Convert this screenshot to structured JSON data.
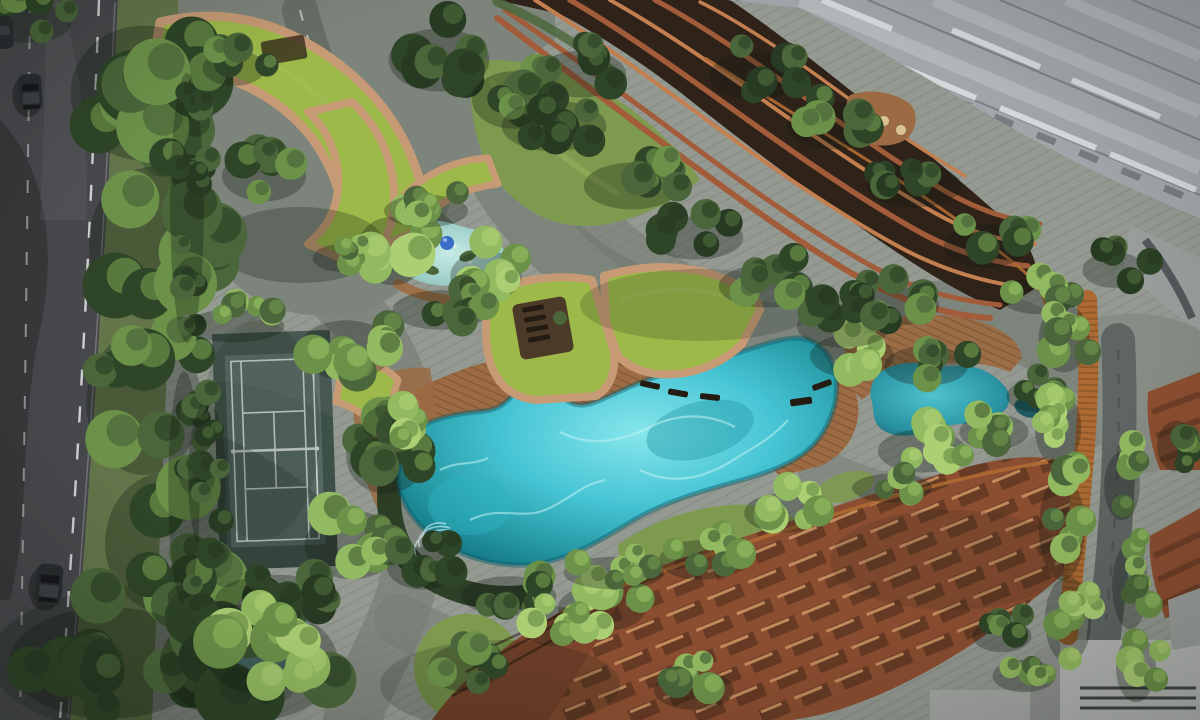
{
  "scene": {
    "type": "architectural-aerial-rendering",
    "description": "Top-down day rendering of a condominium landscape deck: free-form lagoon pool, tennis court, curved green-roof canopies, terracotta balcony towers, timber decks, corten boardwalk and dense tropical planting beside a tree-lined avenue",
    "text_visible": false
  },
  "features": [
    "two-lane-avenue-with-street-trees",
    "parked-cars",
    "arrival-court-with-curved-green-roof-canopies",
    "tennis-court",
    "kids-water-play-pool-with-blue-ball",
    "fan-shaped-green-roof-pool-pavilion",
    "free-form-lagoon-pool",
    "timber-sun-decks",
    "leisure-pond",
    "paver-promenade",
    "corten-steel-boardwalk",
    "terracotta-balcony-tower",
    "high-rise-tower-diagonal-facade",
    "rooftop-terrace-with-daybeds",
    "terraced-terracotta-roofscape",
    "grey-podium-roofs",
    "lawn-mounds-and-hedges"
  ],
  "vehicles": {
    "count": 3,
    "body_color": "#2a2d2f"
  },
  "colors": {
    "asphalt": "#46484b",
    "roadMark": "#e6e8e7",
    "verge": "#64754a",
    "lawn": "#7e9a4f",
    "lawnLight": "#a8c166",
    "canopyGreen": "#9cb94a",
    "canopyRim": "#c69a74",
    "canopyRimDark": "#9b6946",
    "treeDark": "#2e4527",
    "treeMid": "#4a663a",
    "treeLight": "#6c9249",
    "treePale": "#92ba60",
    "palm": "#adcf74",
    "hedge": "#273a22",
    "paving": "#949a92",
    "pavingDark": "#767d74",
    "pavingDeep": "#5e655e",
    "deck": "#9c6b43",
    "deckLight": "#bb8b59",
    "poolDeep": "#0f6f7e",
    "poolMid": "#2aa2b4",
    "poolBright": "#57d0de",
    "poolPale": "#aef0f2",
    "kidsPool": "#9cd2cc",
    "pondTeal": "#2f9fae",
    "pondDark": "#1e5a63",
    "courtBase": "#3d5048",
    "courtInner": "#5e706c",
    "courtLine": "#ccd5d1",
    "terracotta": "#a25c3a",
    "terracottaLight": "#c47f51",
    "terracottaDark": "#2f2219",
    "roofBase": "#8c4e31",
    "roofLight": "#c68e60",
    "roofShadow": "#432818",
    "towerGrey": "#a2a6aa",
    "towerLight": "#c6c9cc",
    "towerDark": "#55595d",
    "towerWhite": "#dcdee0",
    "corten": "#ad6a33",
    "cortenDark": "#7c4a22",
    "carBody": "#2a2d2f",
    "ball": "#3a6cc8"
  }
}
